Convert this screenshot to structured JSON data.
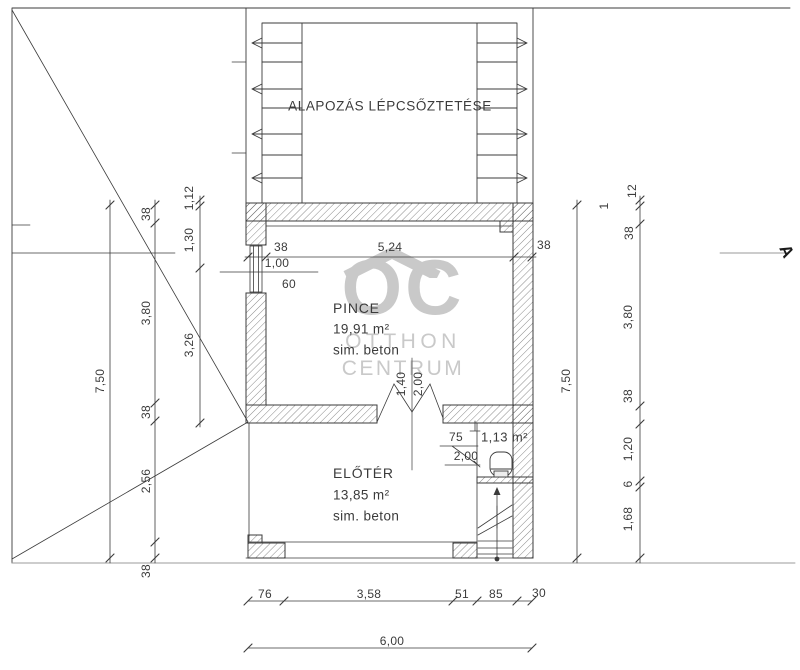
{
  "drawing": {
    "foundation_title": "ALAPOZÁS LÉPCSŐZTETÉSE",
    "section": {
      "marker": "A"
    },
    "rooms": {
      "pince": {
        "name": "PINCE",
        "area": "19,91 m²",
        "floor": "sim. beton"
      },
      "eloter": {
        "name": "ELŐTÉR",
        "area": "13,85 m²",
        "floor": "sim. beton"
      },
      "wc": {
        "area": "1,13 m²"
      }
    },
    "watermark": {
      "logo": "OC",
      "line1": "OTTHON",
      "line2": "CENTRUM"
    },
    "colors": {
      "line": "#3b3b3b",
      "watermark": "#c9c9c9",
      "page_line": "#9b9b9b"
    }
  },
  "dimension_chains": {
    "top": [
      "38",
      "5,24",
      "38"
    ],
    "window": [
      "1,00",
      "60"
    ],
    "left_outer": [
      "7,50"
    ],
    "left_main": [
      "38",
      "3,80",
      "38",
      "2,56",
      "38"
    ],
    "left_inner": [
      "1,12",
      "1,30",
      "3,26"
    ],
    "right_outer": [
      "7,50"
    ],
    "right_main": [
      "1",
      "12",
      "38",
      "3,80",
      "38",
      "1,20",
      "6",
      "1,68"
    ],
    "pince_door": [
      "1,40",
      "2,00"
    ],
    "wc_door": [
      "75",
      "2,00"
    ],
    "bottom": [
      "76",
      "3,58",
      "51",
      "85",
      "30"
    ],
    "bottom_total": [
      "6,00"
    ]
  },
  "dim_labels": [
    {
      "text": "38",
      "x": 281,
      "y": 247,
      "rot": 0,
      "chain": "top"
    },
    {
      "text": "5,24",
      "x": 390,
      "y": 247,
      "rot": 0,
      "chain": "top"
    },
    {
      "text": "38",
      "x": 544,
      "y": 245,
      "rot": 0,
      "chain": "top"
    },
    {
      "text": "1,00",
      "x": 277,
      "y": 263,
      "rot": 0,
      "chain": "window"
    },
    {
      "text": "60",
      "x": 289,
      "y": 284,
      "rot": 0,
      "chain": "window"
    },
    {
      "text": "7,50",
      "x": 100,
      "y": 381,
      "rot": 1,
      "chain": "left-outer"
    },
    {
      "text": "38",
      "x": 146,
      "y": 214,
      "rot": 1,
      "chain": "left-main"
    },
    {
      "text": "3,80",
      "x": 146,
      "y": 313,
      "rot": 1,
      "chain": "left-main"
    },
    {
      "text": "38",
      "x": 146,
      "y": 412,
      "rot": 1,
      "chain": "left-main"
    },
    {
      "text": "2,56",
      "x": 146,
      "y": 481,
      "rot": 1,
      "chain": "left-main"
    },
    {
      "text": "38",
      "x": 146,
      "y": 571,
      "rot": 1,
      "chain": "left-main"
    },
    {
      "text": "1,12",
      "x": 189,
      "y": 198,
      "rot": 1,
      "chain": "left-inner"
    },
    {
      "text": "1,30",
      "x": 189,
      "y": 240,
      "rot": 1,
      "chain": "left-inner"
    },
    {
      "text": "3,26",
      "x": 189,
      "y": 345,
      "rot": 1,
      "chain": "left-inner"
    },
    {
      "text": "7,50",
      "x": 566,
      "y": 381,
      "rot": 1,
      "chain": "right-outer"
    },
    {
      "text": "1",
      "x": 604,
      "y": 206,
      "rot": 1,
      "chain": "right-main"
    },
    {
      "text": "12",
      "x": 632,
      "y": 191,
      "rot": 1,
      "chain": "right-main"
    },
    {
      "text": "38",
      "x": 629,
      "y": 233,
      "rot": 1,
      "chain": "right-main"
    },
    {
      "text": "3,80",
      "x": 628,
      "y": 317,
      "rot": 1,
      "chain": "right-main"
    },
    {
      "text": "38",
      "x": 628,
      "y": 396,
      "rot": 1,
      "chain": "right-main"
    },
    {
      "text": "1,20",
      "x": 628,
      "y": 449,
      "rot": 1,
      "chain": "right-main"
    },
    {
      "text": "6",
      "x": 628,
      "y": 484,
      "rot": 1,
      "chain": "right-main"
    },
    {
      "text": "1,68",
      "x": 628,
      "y": 519,
      "rot": 1,
      "chain": "right-main"
    },
    {
      "text": "1,40",
      "x": 401,
      "y": 384,
      "rot": 1,
      "chain": "pince-door"
    },
    {
      "text": "2,00",
      "x": 418,
      "y": 384,
      "rot": 1,
      "chain": "pince-door"
    },
    {
      "text": "75",
      "x": 456,
      "y": 437,
      "rot": 0,
      "chain": "wc-door"
    },
    {
      "text": "2,00",
      "x": 466,
      "y": 456,
      "rot": 0,
      "chain": "wc-door"
    },
    {
      "text": "76",
      "x": 265,
      "y": 594,
      "rot": 0,
      "chain": "bottom"
    },
    {
      "text": "3,58",
      "x": 369,
      "y": 594,
      "rot": 0,
      "chain": "bottom"
    },
    {
      "text": "51",
      "x": 462,
      "y": 594,
      "rot": 0,
      "chain": "bottom"
    },
    {
      "text": "85",
      "x": 496,
      "y": 594,
      "rot": 0,
      "chain": "bottom"
    },
    {
      "text": "30",
      "x": 539,
      "y": 593,
      "rot": 0,
      "chain": "bottom"
    },
    {
      "text": "6,00",
      "x": 392,
      "y": 641,
      "rot": 0,
      "chain": "bottom-total"
    }
  ]
}
